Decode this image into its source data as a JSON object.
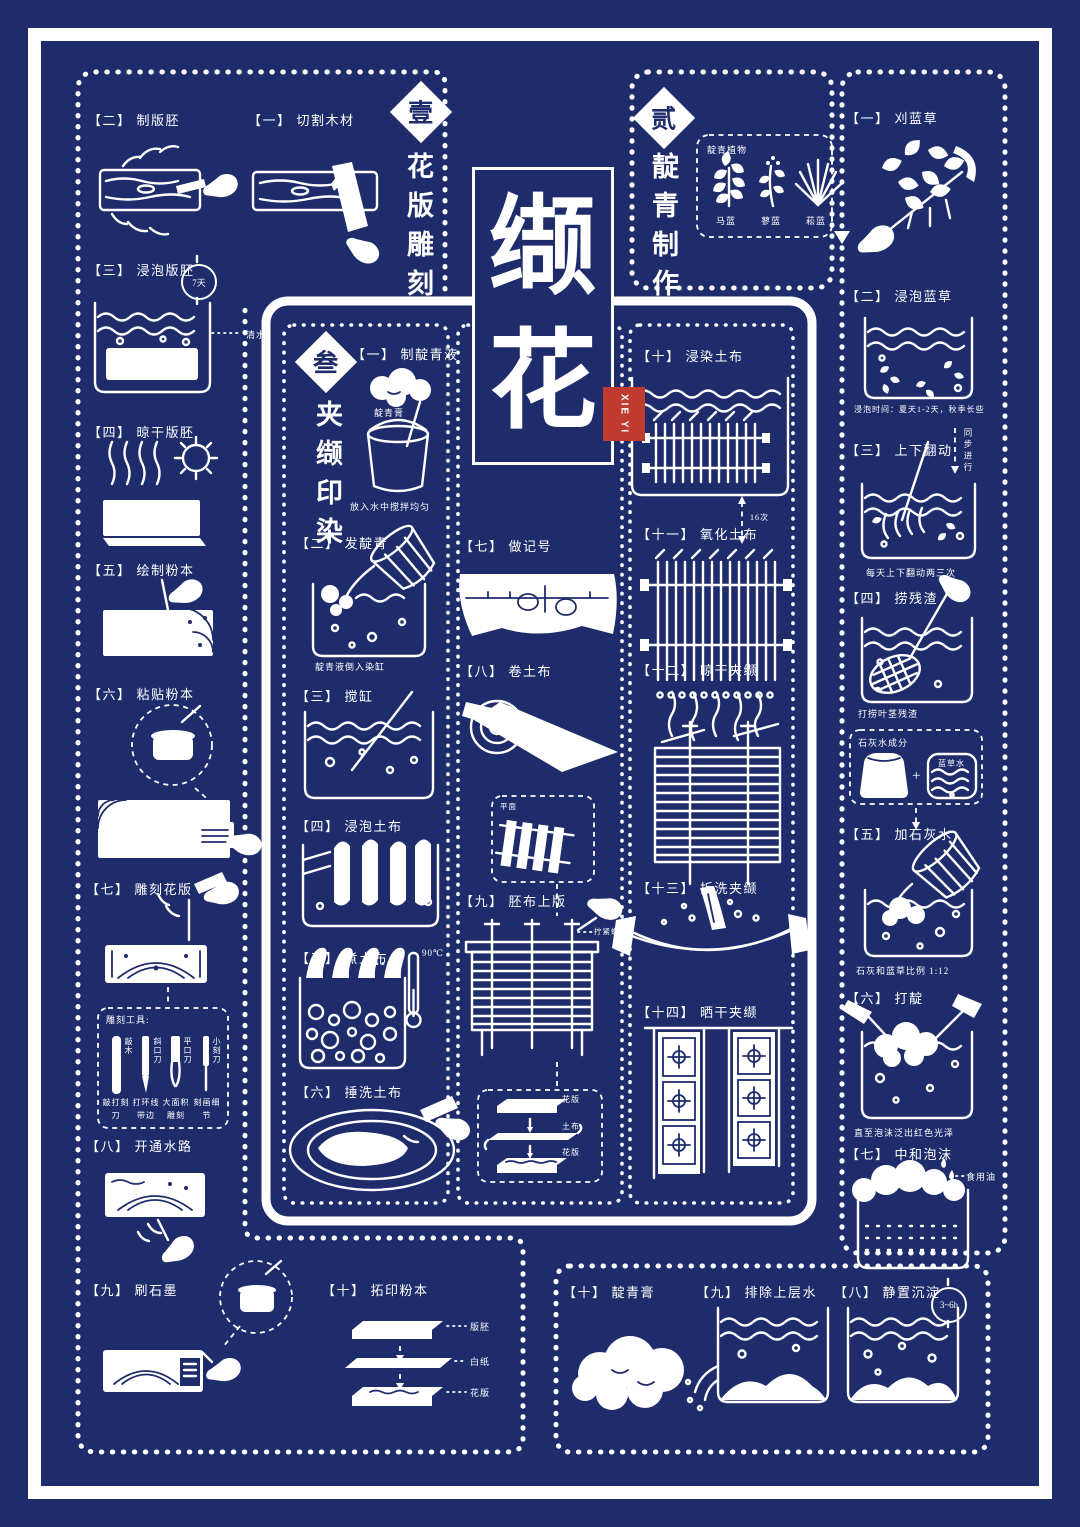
{
  "colors": {
    "navy": "#1f2c6b",
    "white": "#ffffff",
    "seal_red": "#bf3a2f"
  },
  "title": {
    "char1": "缬",
    "char2": "花",
    "seal": "XIE YI"
  },
  "s1": {
    "num": "壹",
    "name": "花版雕刻",
    "steps": {
      "cut": {
        "tag": "【一】",
        "label": "切割木材"
      },
      "blank": {
        "tag": "【二】",
        "label": "制版胚"
      },
      "soak": {
        "tag": "【三】",
        "label": "浸泡版胚",
        "badge": "7天",
        "note": "清水"
      },
      "dry": {
        "tag": "【四】",
        "label": "晾干版胚"
      },
      "draw": {
        "tag": "【五】",
        "label": "绘制粉本"
      },
      "paste": {
        "tag": "【六】",
        "label": "粘贴粉本"
      },
      "carve": {
        "tag": "【七】",
        "label": "雕刻花版"
      },
      "channel": {
        "tag": "【八】",
        "label": "开通水路"
      },
      "ink": {
        "tag": "【九】",
        "label": "刷石墨"
      },
      "rub": {
        "tag": "【十】",
        "label": "拓印粉本",
        "layer1": "版胚",
        "layer2": "白纸",
        "layer3": "花版"
      }
    },
    "tools": {
      "title": "雕刻工具:",
      "t1": "敲木",
      "t1_use": "敲打刻刀",
      "t2": "斜口刀",
      "t2_use": "打环线带边",
      "t3": "平口刀",
      "t3_use": "大面积雕刻",
      "t4": "小刻刀",
      "t4_use": "刻画细节"
    }
  },
  "s2": {
    "num": "贰",
    "name": "靛青制作",
    "plants": {
      "title": "靛青植物",
      "p1": "马蓝",
      "p2": "蓼蓝",
      "p3": "菘蓝"
    },
    "steps": {
      "cut": {
        "tag": "【一】",
        "label": "刈蓝草"
      },
      "soak": {
        "tag": "【二】",
        "label": "浸泡蓝草",
        "caption": "浸泡时间：夏天1-2天，秋季长些"
      },
      "turn": {
        "tag": "【三】",
        "label": "上下翻动",
        "note": "同步进行",
        "caption": "每天上下翻动两三次"
      },
      "scoop": {
        "tag": "【四】",
        "label": "捞残渣",
        "caption": "打捞叶茎残渣"
      },
      "lime": {
        "title": "石灰水成分",
        "item1": "石灰",
        "plus": "+",
        "item2": "蓝草水"
      },
      "add_lime": {
        "tag": "【五】",
        "label": "加石灰水",
        "caption": "石灰和蓝草比例 1:12"
      },
      "beat": {
        "tag": "【六】",
        "label": "打靛",
        "caption": "直至泡沫泛出红色光泽"
      },
      "neutralize": {
        "tag": "【七】",
        "label": "中和泡沫",
        "note": "食用油"
      },
      "settle": {
        "tag": "【八】",
        "label": "静置沉淀",
        "badge": "3~6h"
      },
      "drain": {
        "tag": "【九】",
        "label": "排除上层水"
      },
      "paste": {
        "tag": "【十】",
        "label": "靛青膏"
      }
    }
  },
  "s3": {
    "num": "叁",
    "name": "夹缬印染",
    "steps": {
      "liquid": {
        "tag": "【一】",
        "label": "制靛青液",
        "note": "靛青膏",
        "caption": "放入水中搅拌均匀"
      },
      "ferment": {
        "tag": "【二】",
        "label": "发靛青",
        "caption": "靛青液倒入染缸"
      },
      "stir": {
        "tag": "【三】",
        "label": "搅缸"
      },
      "soak": {
        "tag": "【四】",
        "label": "浸泡土布"
      },
      "boil": {
        "tag": "【五】",
        "label": "煮土布",
        "temp": "90℃"
      },
      "wash": {
        "tag": "【六】",
        "label": "捶洗土布"
      },
      "mark": {
        "tag": "【七】",
        "label": "做记号"
      },
      "roll": {
        "tag": "【八】",
        "label": "卷土布"
      },
      "inset": {
        "label": "平面"
      },
      "clamp": {
        "tag": "【九】",
        "label": "胚布上版",
        "note": "拧紧螺帽",
        "layer1": "花版",
        "layer2": "土布",
        "layer3": "花版"
      },
      "dye": {
        "tag": "【十】",
        "label": "浸染土布",
        "times": "16次"
      },
      "oxidize": {
        "tag": "【十一】",
        "label": "氧化土布"
      },
      "drip": {
        "tag": "【十二】",
        "label": "晾干夹缬"
      },
      "unclamp": {
        "tag": "【十三】",
        "label": "拆洗夹缬"
      },
      "sun": {
        "tag": "【十四】",
        "label": "晒干夹缬"
      }
    }
  }
}
